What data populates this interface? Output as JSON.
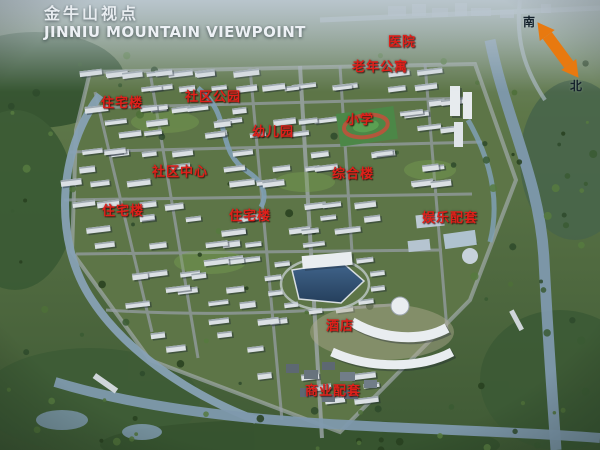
{
  "header": {
    "title_cn": "金牛山视点",
    "title_en": "JINNIU MOUNTAIN VIEWPOINT"
  },
  "compass": {
    "south": "南",
    "north": "北",
    "arrow_color": "#e8790f"
  },
  "colors": {
    "label_red": "#df201a",
    "water": "#87a1b4",
    "lake": "#2f4f74",
    "land_green": "#54713f",
    "building": "#dbe0e4"
  },
  "map_labels": [
    {
      "id": "hospital",
      "text": "医院",
      "x": 388,
      "y": 31
    },
    {
      "id": "senior-apartments",
      "text": "老年公寓",
      "x": 352,
      "y": 56
    },
    {
      "id": "residential-1",
      "text": "住宅楼",
      "x": 101,
      "y": 92
    },
    {
      "id": "community-park",
      "text": "社区公园",
      "x": 185,
      "y": 86
    },
    {
      "id": "kindergarten",
      "text": "幼儿园",
      "x": 252,
      "y": 121
    },
    {
      "id": "primary-school",
      "text": "小学",
      "x": 346,
      "y": 109
    },
    {
      "id": "community-center",
      "text": "社区中心",
      "x": 152,
      "y": 161
    },
    {
      "id": "complex-building",
      "text": "综合楼",
      "x": 332,
      "y": 163
    },
    {
      "id": "residential-2",
      "text": "住宅楼",
      "x": 102,
      "y": 200
    },
    {
      "id": "residential-3",
      "text": "住宅楼",
      "x": 229,
      "y": 205
    },
    {
      "id": "entertainment-facilities",
      "text": "娱乐配套",
      "x": 422,
      "y": 207
    },
    {
      "id": "hotel",
      "text": "酒店",
      "x": 326,
      "y": 315
    },
    {
      "id": "commercial-facilities",
      "text": "商业配套",
      "x": 305,
      "y": 380
    }
  ]
}
